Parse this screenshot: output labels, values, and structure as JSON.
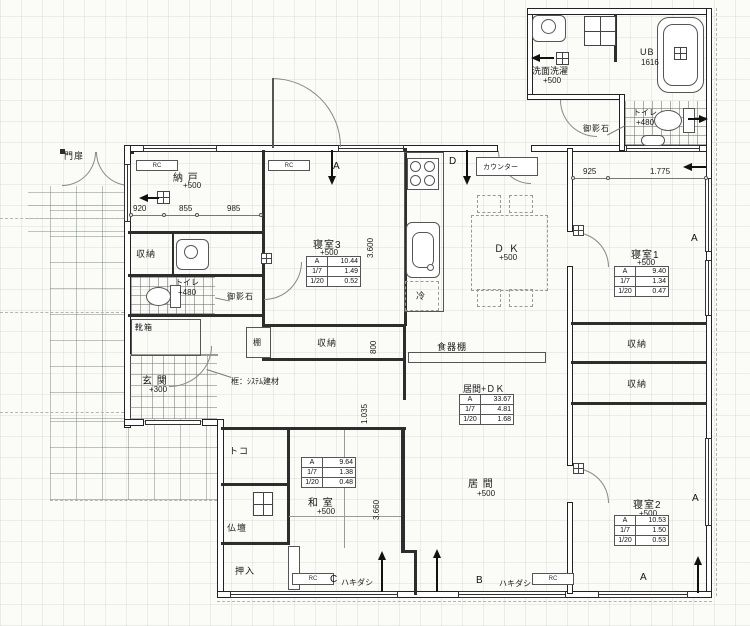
{
  "rooms": {
    "nando": {
      "name": "納 戸",
      "level": "+500"
    },
    "bedroom3": {
      "name": "寝室3",
      "level": "+500"
    },
    "bedroom1": {
      "name": "寝室1",
      "level": "+500"
    },
    "bedroom2": {
      "name": "寝室2",
      "level": "+500"
    },
    "washitsu": {
      "name": "和 室",
      "level": "+500"
    },
    "ima": {
      "name": "居 間",
      "level": "+500"
    },
    "dk": {
      "name": "Ｄ Ｋ",
      "level": "+500"
    },
    "senmen": {
      "name": "洗面洗濯",
      "level": "+500"
    },
    "ub": {
      "name": "UB",
      "size": "1616"
    },
    "toilet_top": {
      "name": "トイレ",
      "level": "+480"
    },
    "toilet_left": {
      "name": "トイレ",
      "level": "+480"
    },
    "genkan": {
      "name": "玄 関",
      "level": "+300"
    }
  },
  "areas": {
    "ima_dk_title": "居間+ＤＫ",
    "bedroom3": [
      [
        "A",
        "10.44"
      ],
      [
        "1/7",
        "1.49"
      ],
      [
        "1/20",
        "0.52"
      ]
    ],
    "bedroom1": [
      [
        "A",
        "9.40"
      ],
      [
        "1/7",
        "1.34"
      ],
      [
        "1/20",
        "0.47"
      ]
    ],
    "bedroom2": [
      [
        "A",
        "10.53"
      ],
      [
        "1/7",
        "1.50"
      ],
      [
        "1/20",
        "0.53"
      ]
    ],
    "washitsu": [
      [
        "A",
        "9.64"
      ],
      [
        "1/7",
        "1.38"
      ],
      [
        "1/20",
        "0.48"
      ]
    ],
    "ima_dk": [
      [
        "A",
        "33.67"
      ],
      [
        "1/7",
        "4.81"
      ],
      [
        "1/20",
        "1.68"
      ]
    ]
  },
  "storage": {
    "shuno": "収納",
    "tana": "棚",
    "shokkidana": "食器棚",
    "kutsubako": "靴箱",
    "oshiire": "押入",
    "toko": "トコ",
    "butsudan": "仏壇"
  },
  "annotations": {
    "monpi": "門扉",
    "mikageishi": "御影石",
    "kamachi": "框：ｼｽﾃﾑ建材",
    "counter": "カウンター",
    "hakidashi": "ハキダシ",
    "rei": "冷",
    "rc": "RC"
  },
  "dims": {
    "d920": "920",
    "d855": "855",
    "d985": "985",
    "d925": "925",
    "d1775": "1.775",
    "d3600": "3.600",
    "d800": "800",
    "d1035": "1.035",
    "d3660": "3.660"
  },
  "markers": {
    "a": "A",
    "b": "B",
    "c": "C",
    "d": "D"
  }
}
